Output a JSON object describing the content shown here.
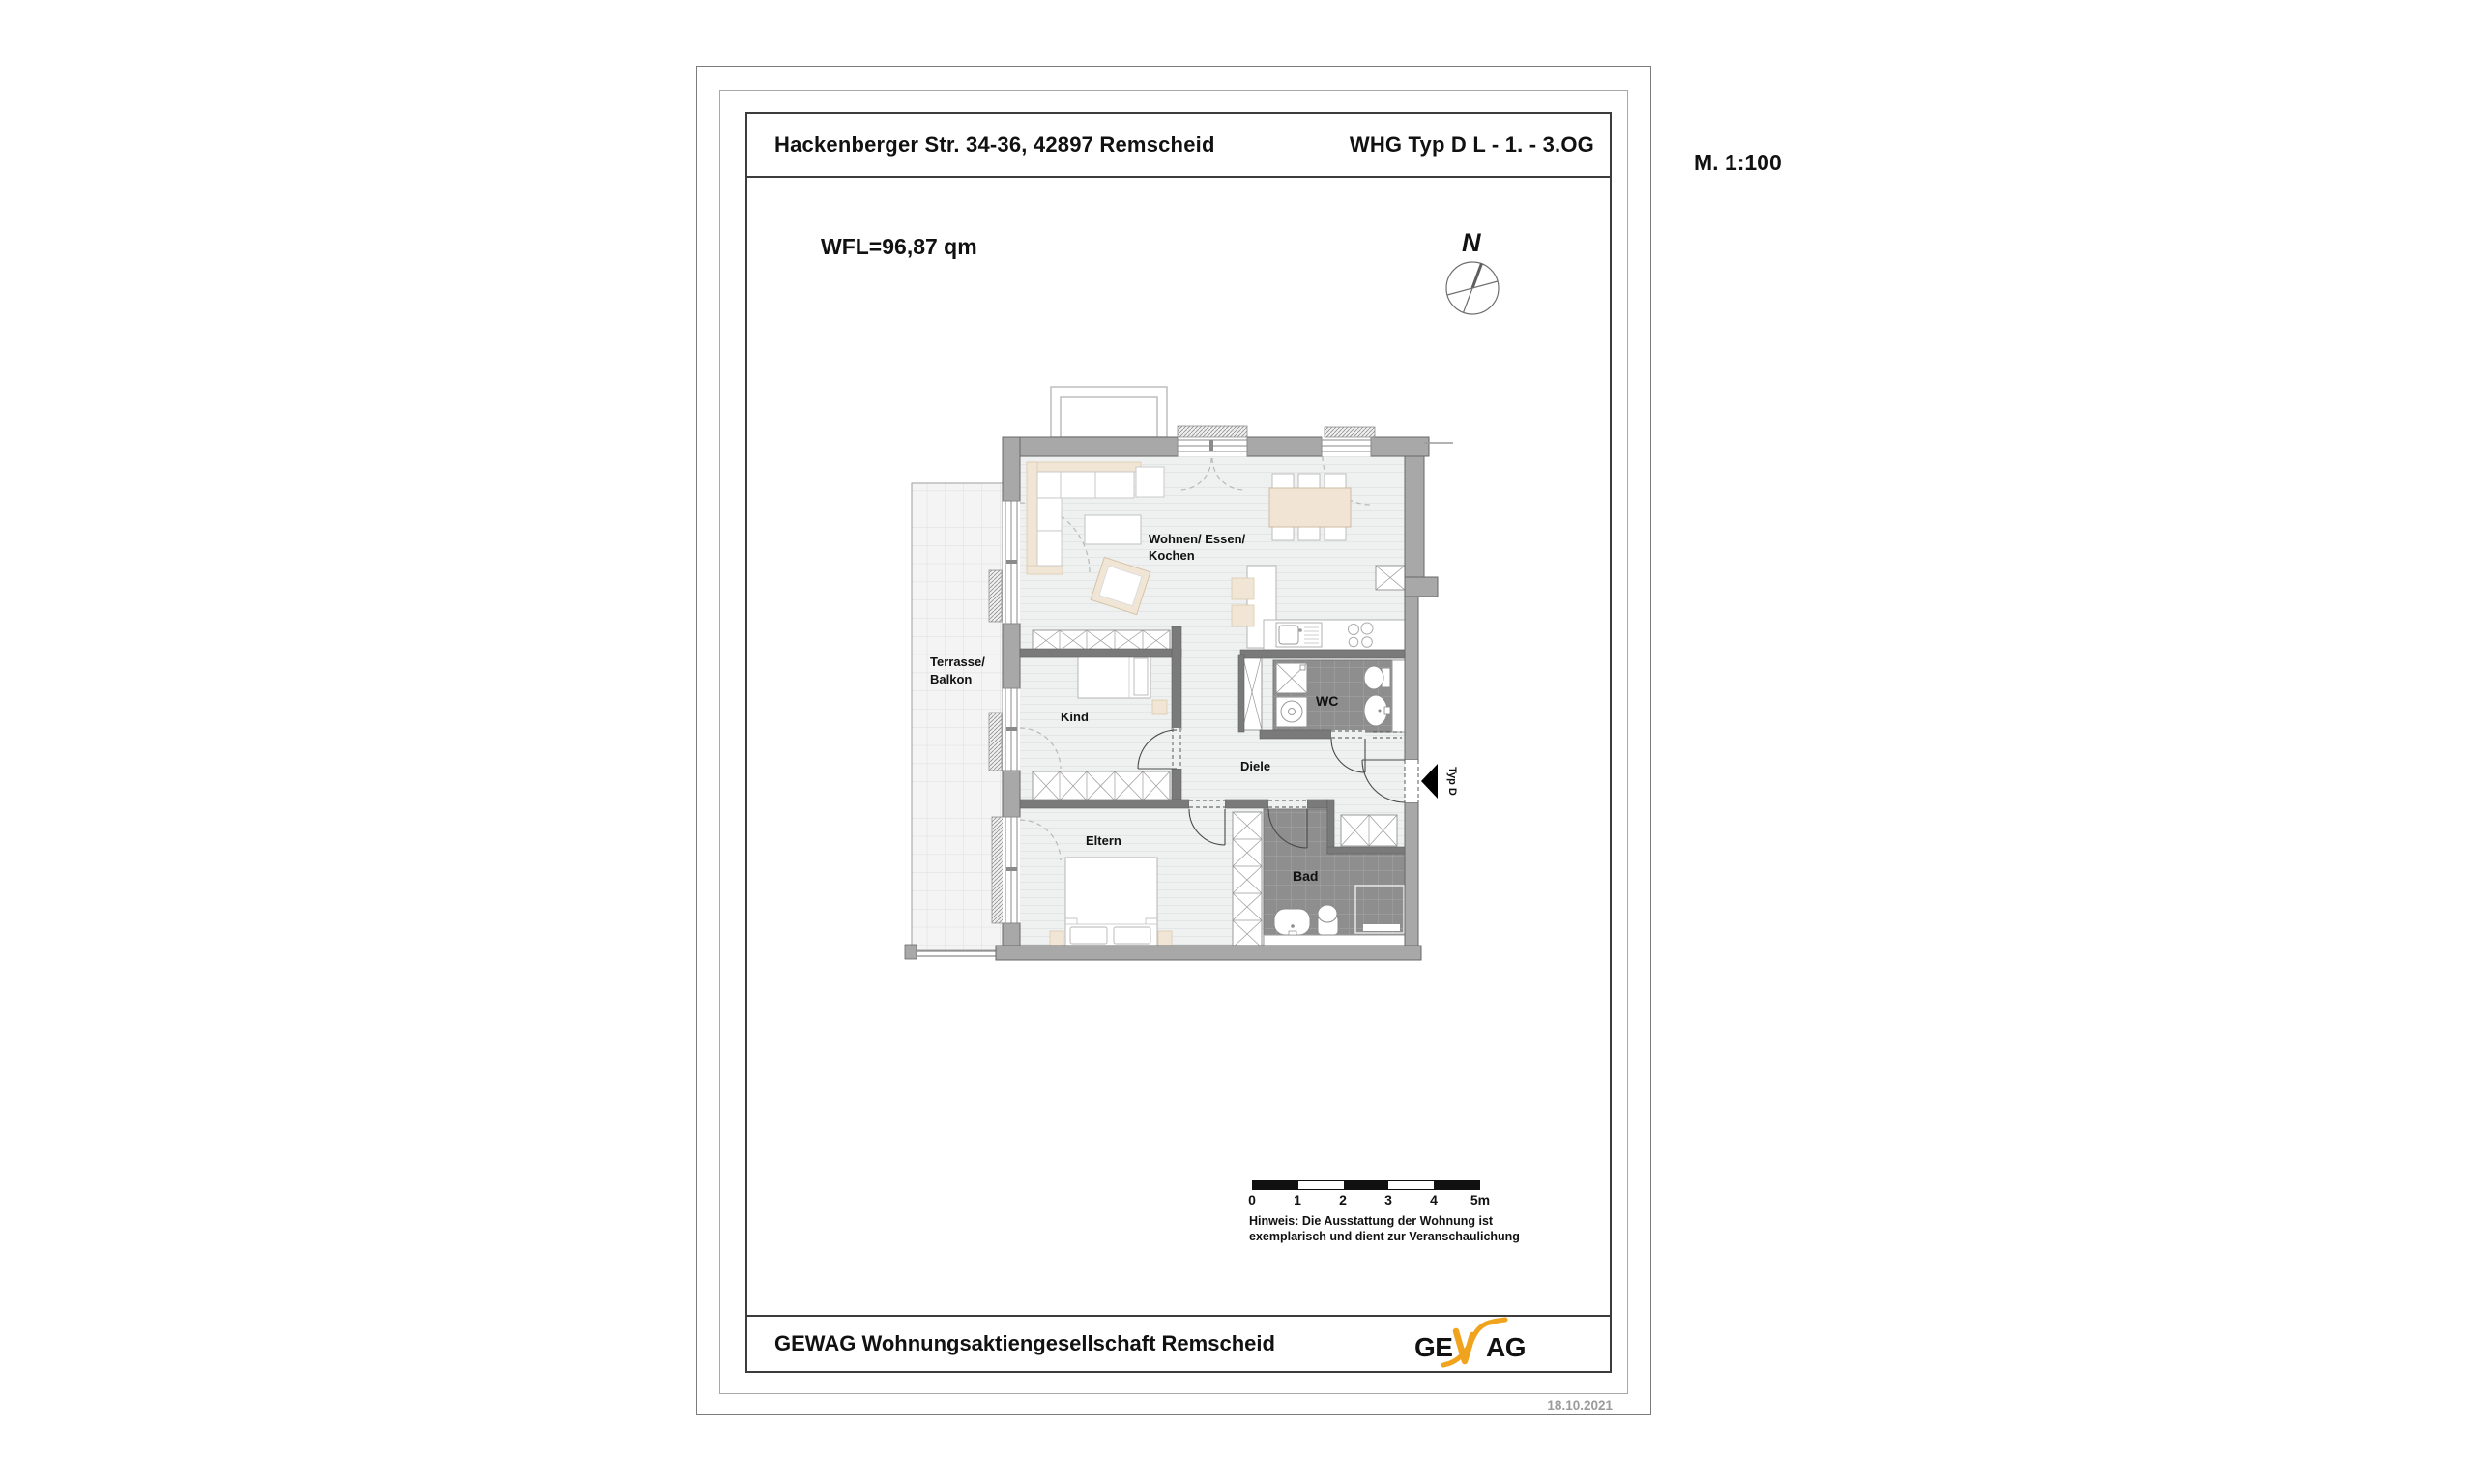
{
  "header": {
    "address": "Hackenberger Str. 34-36, 42897 Remscheid",
    "unit": "WHG Typ D L - 1. - 3.OG"
  },
  "annotations": {
    "scale": "M. 1:100",
    "area": "WFL=96,87 qm",
    "north": "N",
    "entrance": "Typ D",
    "date": "18.10.2021"
  },
  "rooms": {
    "living_line1": "Wohnen/ Essen/",
    "living_line2": "Kochen",
    "terrace_line1": "Terrasse/",
    "terrace_line2": "Balkon",
    "child": "Kind",
    "hall": "Diele",
    "wc": "WC",
    "parents": "Eltern",
    "bath": "Bad"
  },
  "scalebar": {
    "labels": [
      "0",
      "1",
      "2",
      "3",
      "4",
      "5m"
    ]
  },
  "note": {
    "line1": "Hinweis: Die Ausstattung der Wohnung ist",
    "line2": "exemplarisch und dient zur Veranschaulichung"
  },
  "footer": {
    "company": "GEWAG Wohnungsaktiengesellschaft Remscheid",
    "logo": {
      "ge": "GE",
      "w": "W",
      "ag": "AG"
    }
  },
  "colors": {
    "wall_exterior": "#a8a8a8",
    "wall_interior": "#7a7a7a",
    "tile_dark": "#8e8e8e",
    "floor": "#eff0f0",
    "furniture_beige": "#f1e6d6",
    "logo_red": "#c23b28",
    "logo_yellow": "#f0a31c"
  }
}
